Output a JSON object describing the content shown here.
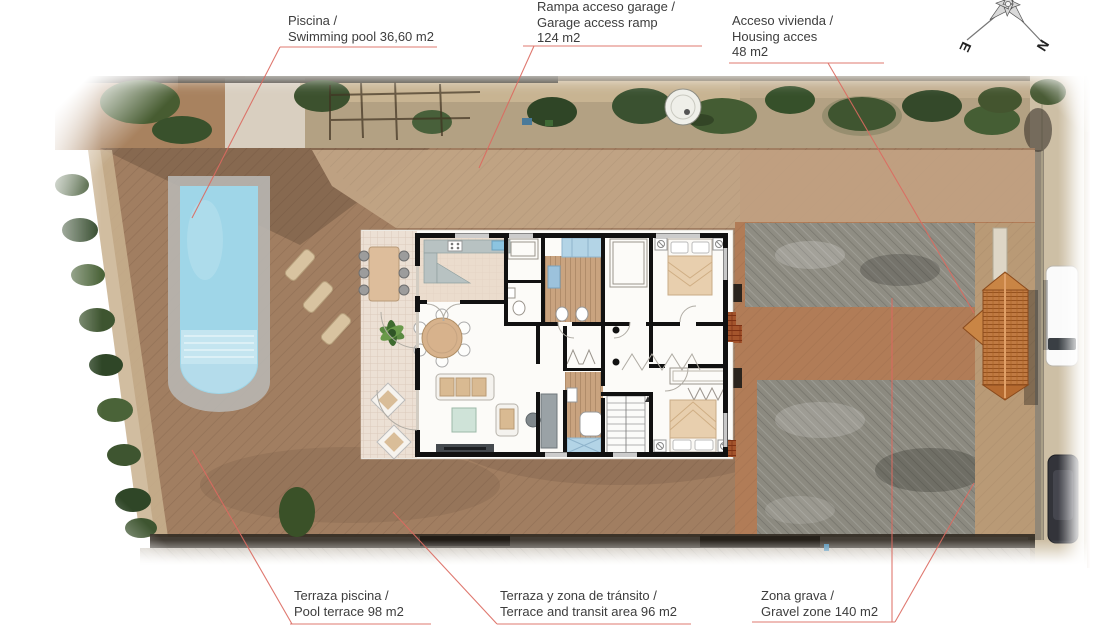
{
  "annotations": {
    "pool": {
      "line1": "Piscina /",
      "line2": "Swimming pool 36,60 m2"
    },
    "garage_ramp": {
      "line1": "Rampa acceso garage /",
      "line2": "Garage access ramp",
      "line3": "124 m2"
    },
    "housing_access": {
      "line1": "Acceso vivienda /",
      "line2": "Housing acces",
      "line3": "48 m2"
    },
    "pool_terrace": {
      "line1": "Terraza piscina /",
      "line2": "Pool terrace 98 m2"
    },
    "transit_area": {
      "line1": "Terraza y zona de tránsito /",
      "line2": "Terrace and transit area 96 m2"
    },
    "gravel_zone": {
      "line1": "Zona grava /",
      "line2": "Gravel zone 140 m2"
    }
  },
  "areas_m2": {
    "swimming_pool": "36,60",
    "garage_ramp": "124",
    "housing_access": "48",
    "pool_terrace": "98",
    "transit_area": "96",
    "gravel_zone": "140"
  },
  "compass": {
    "east_label": "E",
    "north_label": "N"
  },
  "colors": {
    "leader_line": "#dc6a60",
    "label_text": "#3d3d3d",
    "pool_water": "#9fd6e8",
    "terrace_brown": "#a17e61",
    "gravel_gray": "#8d8b81",
    "roof_tile": "#c07a42"
  }
}
